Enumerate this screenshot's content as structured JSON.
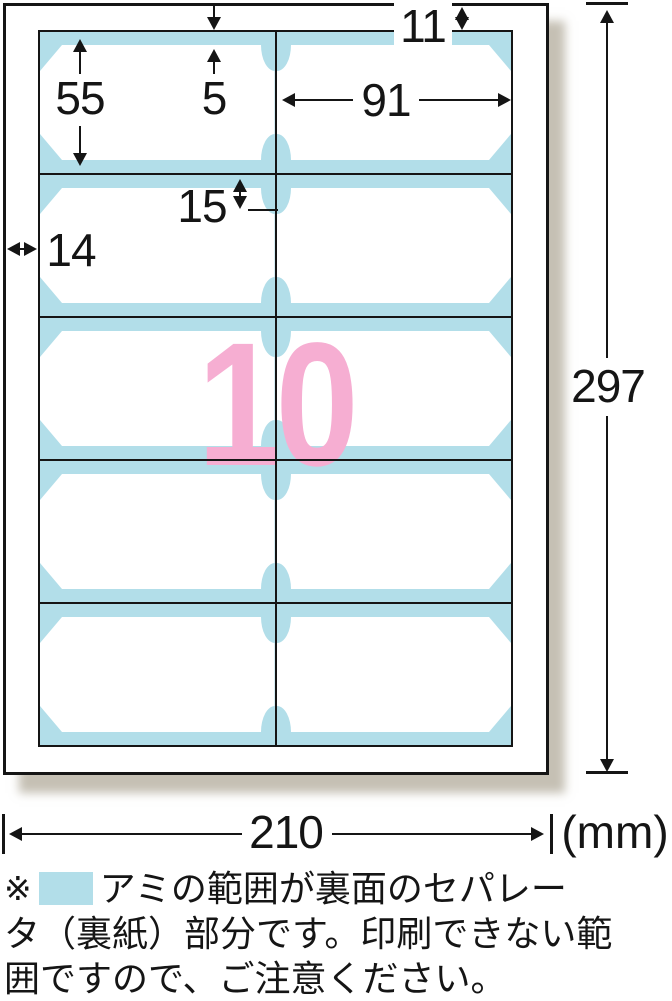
{
  "diagram": {
    "count": "10",
    "page_width": "210",
    "page_height": "297",
    "top_margin": "11",
    "left_margin": "14",
    "card_height": "55",
    "card_width": "91",
    "separator_band": "5",
    "notch_inset": "15",
    "unit_label": "(mm)",
    "grid": {
      "rows": 5,
      "cols": 2
    }
  },
  "colors": {
    "ink": "#151515",
    "blue": "#b2dee9",
    "pink": "#f6aed2"
  },
  "note": {
    "marker": "※",
    "line1": "アミの範囲が裏面のセパレー",
    "line2": "タ（裏紙）部分です。印刷できない範",
    "line3": "囲ですので、ご注意ください。"
  }
}
